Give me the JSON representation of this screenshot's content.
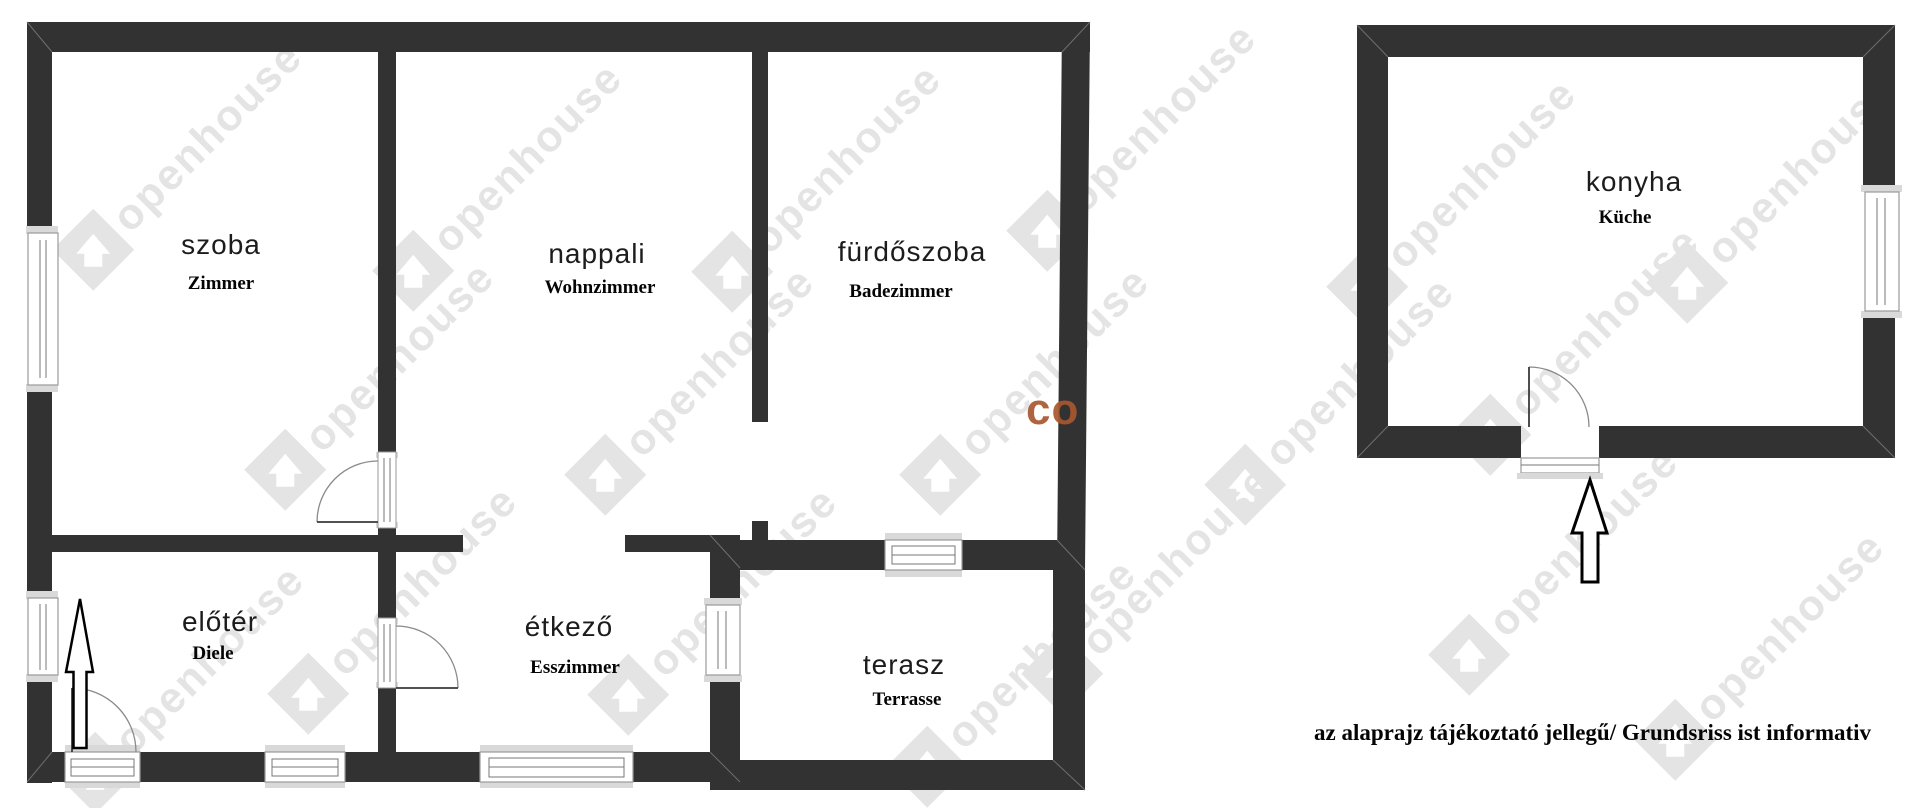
{
  "floorplan": {
    "rooms": [
      {
        "id": "szoba",
        "name": "szoba",
        "translation": "Zimmer"
      },
      {
        "id": "nappali",
        "name": "nappali",
        "translation": "Wohnzimmer"
      },
      {
        "id": "furdoszoba",
        "name": "fürdőszoba",
        "translation": "Badezimmer"
      },
      {
        "id": "eloter",
        "name": "előtér",
        "translation": "Diele"
      },
      {
        "id": "etkezo",
        "name": "étkező",
        "translation": "Esszimmer"
      },
      {
        "id": "terasz",
        "name": "terasz",
        "translation": "Terrasse"
      },
      {
        "id": "konyha",
        "name": "konyha",
        "translation": "Küche"
      }
    ],
    "disclaimer": "az alaprajz tájékoztató jellegű/ Grundsriss ist informativ",
    "watermark": {
      "text": "openhouse",
      "icon": "house-diamond-icon",
      "color": "#e4e4e4",
      "accent_text": "co",
      "accent_color": "#a8572f"
    },
    "colors": {
      "wall": "#323232",
      "window_frame": "#d9d9d9",
      "background": "#ffffff"
    }
  }
}
